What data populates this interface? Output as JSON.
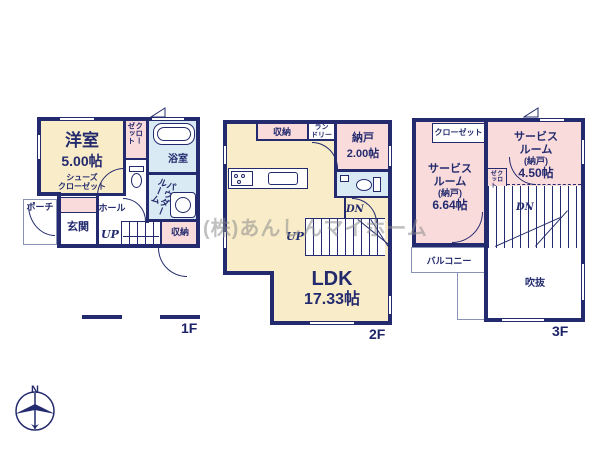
{
  "watermark": "(株)あんしんマイホーム",
  "compass": {
    "north": "N"
  },
  "colors": {
    "wall": "#232b6e",
    "room_cream": "#f9ecc8",
    "room_pink": "#fadbdc",
    "room_blue": "#d9eaf4",
    "thin_line": "#8a92b8",
    "watermark_gray": "#8c8c8c"
  },
  "floors": {
    "f1": {
      "label": "1F",
      "rooms": {
        "western_room": {
          "name": "洋室",
          "size": "5.00帖"
        },
        "shoes_closet": {
          "line1": "シューズ",
          "line2": "クローゼット"
        },
        "closet": {
          "line1": "クロー",
          "line2": "ゼット"
        },
        "bath": "浴室",
        "powder_room": {
          "line1": "パウダー",
          "line2": "ルーム"
        },
        "porch": "ポーチ",
        "entrance": "玄関",
        "hall": "ホール",
        "stairs_up": "UP",
        "storage": "収納"
      }
    },
    "f2": {
      "label": "2F",
      "rooms": {
        "storage": "収納",
        "laundry": {
          "line1": "ラン",
          "line2": "ドリー"
        },
        "nando": {
          "name": "納戸",
          "size": "2.00帖"
        },
        "ldk": {
          "name": "LDK",
          "size": "17.33帖"
        },
        "stairs_up": "UP",
        "stairs_dn": "DN"
      }
    },
    "f3": {
      "label": "3F",
      "rooms": {
        "closet": "クローゼット",
        "service_room_1": {
          "name1": "サービス",
          "name2": "ルーム",
          "sub": "(納戸)",
          "size": "6.64帖"
        },
        "service_room_2": {
          "name1": "サービス",
          "name2": "ルーム",
          "sub": "(納戸)",
          "size": "4.50帖"
        },
        "small_closet": {
          "line1": "クロ",
          "line2": "ゼット"
        },
        "stairs_dn": "DN",
        "balcony": "バルコニー",
        "void": "吹抜"
      }
    }
  }
}
